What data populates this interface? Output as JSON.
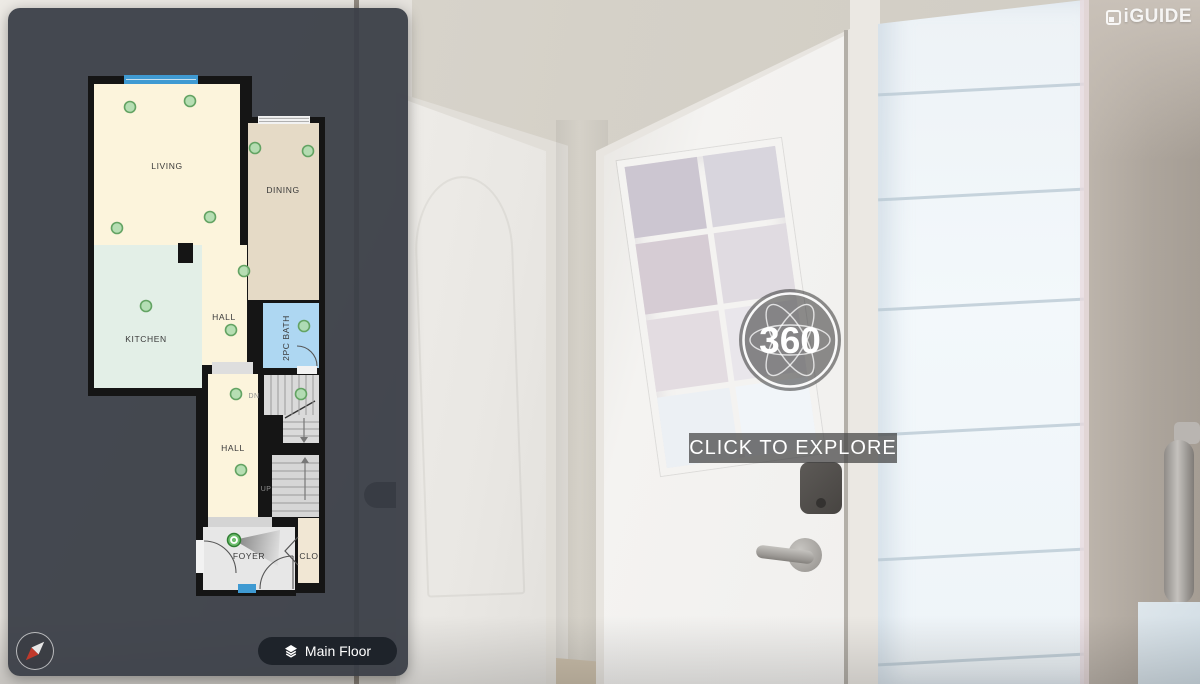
{
  "branding": {
    "logo_text": "iGUIDE"
  },
  "pano": {
    "badge_label": "360",
    "cta_label": "CLICK TO EXPLORE"
  },
  "controls": {
    "floor_button_label": "Main Floor"
  },
  "floorplan": {
    "floor_name": "Main Floor",
    "rooms": [
      {
        "label": "LIVING"
      },
      {
        "label": "DINING"
      },
      {
        "label": "KITCHEN"
      },
      {
        "label": "HALL"
      },
      {
        "label": "2PC BATH"
      },
      {
        "label": "HALL"
      },
      {
        "label": "FOYER"
      },
      {
        "label": "CLO"
      }
    ],
    "stairs": {
      "down_label": "DN",
      "up_label": "UP"
    },
    "markers": [
      {
        "x": 48,
        "y": 37
      },
      {
        "x": 108,
        "y": 31
      },
      {
        "x": 35,
        "y": 158
      },
      {
        "x": 128,
        "y": 147
      },
      {
        "x": 173,
        "y": 78
      },
      {
        "x": 226,
        "y": 81
      },
      {
        "x": 64,
        "y": 236
      },
      {
        "x": 162,
        "y": 201
      },
      {
        "x": 149,
        "y": 260
      },
      {
        "x": 222,
        "y": 256
      },
      {
        "x": 219,
        "y": 324
      },
      {
        "x": 154,
        "y": 324
      },
      {
        "x": 159,
        "y": 400
      }
    ],
    "active_marker": {
      "x": 152,
      "y": 470
    },
    "colors": {
      "room_cream": "#fcf4dc",
      "room_tan": "#e5dac6",
      "room_mint": "#e3efe7",
      "bath_blue": "#aed7f2",
      "window_blue": "#3f9ad2",
      "marker_green": "#aedcae",
      "wall": "#151515",
      "panel_dark": "#393e46"
    }
  }
}
